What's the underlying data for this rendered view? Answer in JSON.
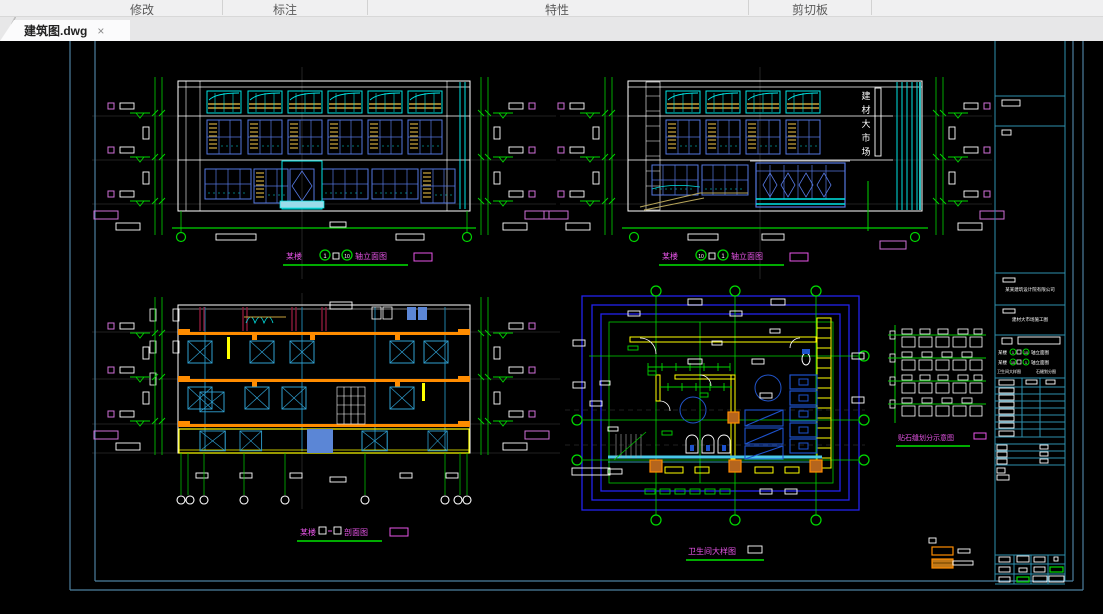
{
  "ribbon": {
    "panels": [
      {
        "label": "修改"
      },
      {
        "label": "标注"
      },
      {
        "label": "特性"
      },
      {
        "label": "剪切板"
      }
    ]
  },
  "tabbar": {
    "tabs": [
      {
        "label": "建筑图.dwg",
        "close_glyph": "×",
        "active": true
      }
    ]
  },
  "canvas": {
    "titles": {
      "elev_left": {
        "prefix": "某楼",
        "axis_start": "1",
        "axis_end": "10",
        "suffix": "轴立面图"
      },
      "elev_right": {
        "prefix": "某楼",
        "axis_start": "10",
        "axis_end": "1",
        "suffix": "轴立面图"
      },
      "section": {
        "prefix": "某楼",
        "suffix": "剖面图"
      },
      "plan": {
        "label": "卫生间大样图"
      },
      "stone": {
        "label": "贴石缝划分示意图"
      }
    },
    "sign": {
      "chars": [
        "建",
        "材",
        "大",
        "市",
        "场"
      ]
    },
    "titleblock": {
      "company": "某某建筑设计院有限公司",
      "project": "建材大市场施工图",
      "list": [
        {
          "prefix": "某楼",
          "a": "1",
          "b": "10",
          "suffix": "轴立面图"
        },
        {
          "prefix": "某楼",
          "a": "10",
          "b": "1",
          "suffix": "轴立面图"
        }
      ],
      "row3_left": "卫生间大样图",
      "row3_right": "石缝划分图"
    },
    "colors": {
      "background": "#000000",
      "sheet_border": "#4d7f9e",
      "titleblock_teal": "#2e8fae",
      "dim_green": "#00d400",
      "title_magenta": "#e755e7",
      "axis_violet": "#cf6fd8",
      "cad_cyan": "#00e5e5",
      "window_blue": "#5577e0",
      "plan_blue": "#2222ee",
      "fixture_blue": "#1d52cc",
      "slab_orange": "#ff8c00",
      "louver_gold": "#c8a23c",
      "wall_yellow": "#ffff00",
      "beam_maroon": "#8b1a3a",
      "guide_gray": "#3f3f3f",
      "line_white": "#ffffff"
    }
  }
}
